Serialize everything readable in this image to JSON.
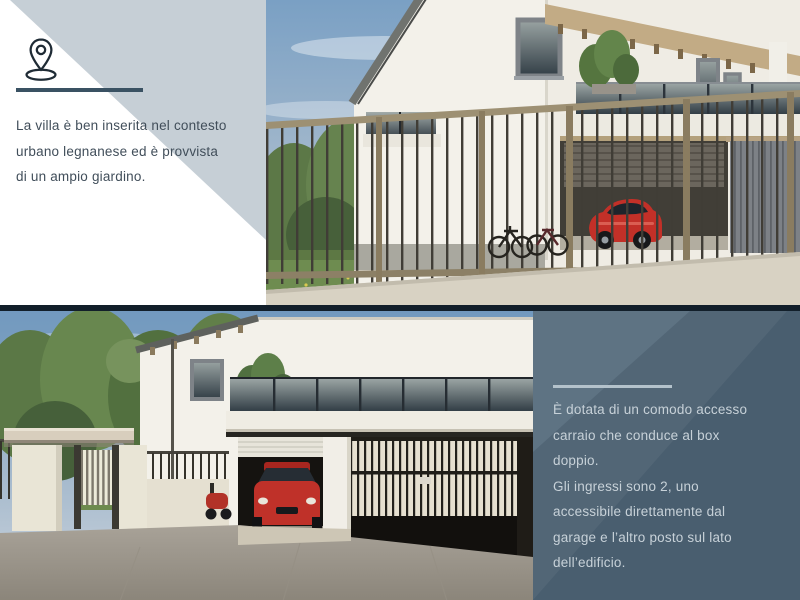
{
  "slide": {
    "type": "real-estate-presentation-slide",
    "language": "it"
  },
  "palette": {
    "accent_light": "#c6cfd6",
    "accent_dark_panel": "#495e6f",
    "accent_panel_triangle": "#5e7383",
    "divider_dark": "#3a5263",
    "divider_light": "#b4c2cb",
    "separator_line": "#121f2a",
    "text_dark": "#414e5a",
    "text_light": "#c7d1d8"
  },
  "intro_panel": {
    "icon": "location-pin-icon",
    "lines": [
      "La villa è ben inserita nel contesto",
      "urbano legnanese ed è provvista",
      "di un ampio giardino."
    ]
  },
  "access_panel": {
    "lines": [
      "È dotata di un comodo accesso",
      "carraio che conduce al box",
      "doppio.",
      "Gli ingressi sono 2, uno",
      "accessibile direttamente dal",
      "garage e l’altro posto sul lato",
      "dell’edificio."
    ]
  },
  "photos": {
    "top": {
      "name": "villa-street-view-render"
    },
    "bottom": {
      "name": "villa-garage-access-render"
    }
  }
}
